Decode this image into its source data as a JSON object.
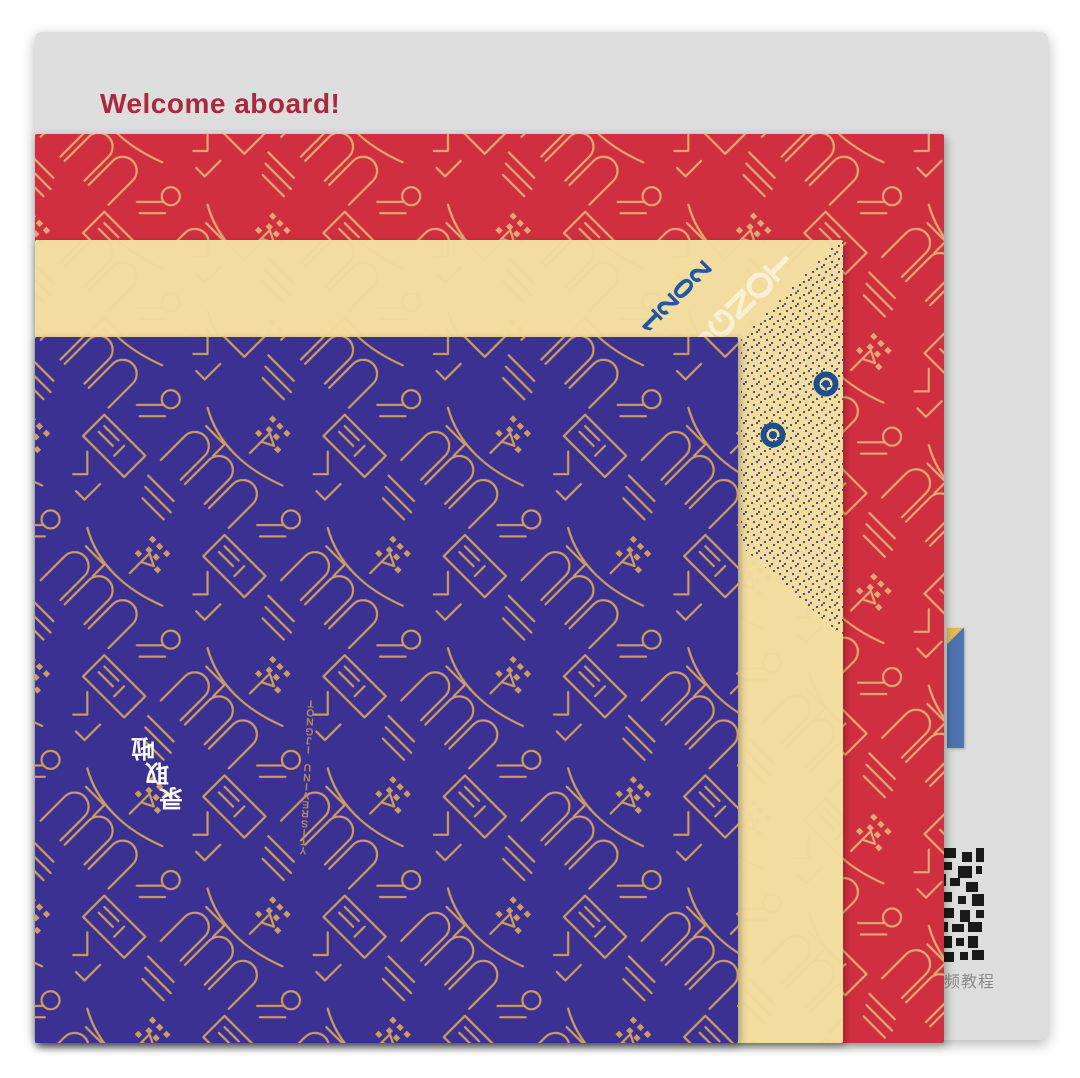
{
  "card": {
    "welcome": "Welcome aboard!",
    "welcome_color": "#a82a3c",
    "bg_color": "#dedede"
  },
  "papers": {
    "red": {
      "bg_color": "#d02f3f",
      "line_color": "#e2a873"
    },
    "cream": {
      "bg_color": "#f3dc9f",
      "line_color": "#e9d59c",
      "year": "2021",
      "year_color": "#2257a5",
      "brand": "TONGJI",
      "brand_color": "#faf0d6",
      "rivet_color": "#1d4f8f",
      "halftone_dot_color": "#515372"
    },
    "blue": {
      "bg_color": "#3a3192",
      "line_color": "#cf9c60",
      "slogan": "录取啦",
      "slogan_color": "#ffffff",
      "pattern_text": "TONGJI UNIVERSITY"
    }
  },
  "side": {
    "qr_caption": "频教程",
    "strip_color": "#4d74b2",
    "strip_cap_color": "#e3bc57"
  }
}
